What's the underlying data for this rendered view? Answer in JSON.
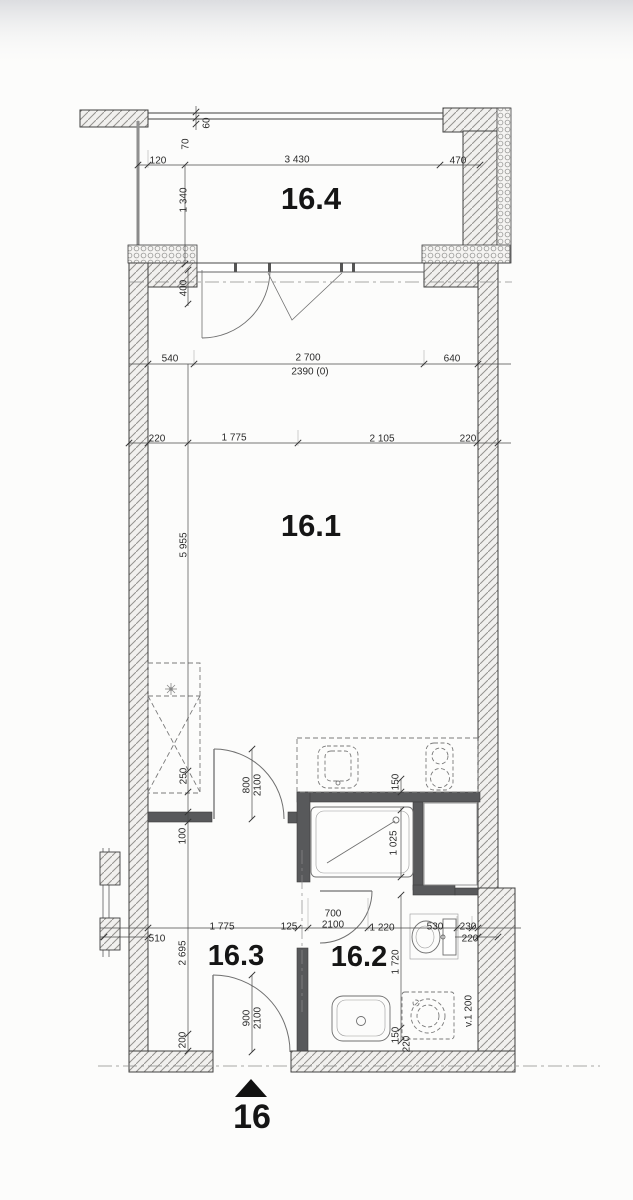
{
  "plan": {
    "title": "apartment-unit-floor-plan",
    "unit": "16",
    "room_labels": [
      {
        "t": "16.4",
        "x": 311,
        "y": 209,
        "size": 31
      },
      {
        "t": "16.1",
        "x": 311,
        "y": 536,
        "size": 31
      },
      {
        "t": "16.3",
        "x": 236,
        "y": 965,
        "size": 29
      },
      {
        "t": "16.2",
        "x": 359,
        "y": 966,
        "size": 29
      },
      {
        "t": "16",
        "x": 252,
        "y": 1128,
        "size": 34
      }
    ],
    "dim_labels": [
      {
        "t": "120",
        "x": 158,
        "y": 160
      },
      {
        "t": "3 430",
        "x": 297,
        "y": 159
      },
      {
        "t": "470",
        "x": 458,
        "y": 160
      },
      {
        "t": "60",
        "x": 206,
        "y": 123,
        "r": 1
      },
      {
        "t": "70",
        "x": 185,
        "y": 144,
        "r": 1
      },
      {
        "t": "1 340",
        "x": 183,
        "y": 200,
        "r": 1
      },
      {
        "t": "400",
        "x": 183,
        "y": 288,
        "r": 1
      },
      {
        "t": "540",
        "x": 170,
        "y": 358
      },
      {
        "t": "2 700",
        "x": 308,
        "y": 357
      },
      {
        "t": "2390 (0)",
        "x": 310,
        "y": 371
      },
      {
        "t": "640",
        "x": 452,
        "y": 358
      },
      {
        "t": "220",
        "x": 157,
        "y": 438
      },
      {
        "t": "1 775",
        "x": 234,
        "y": 437
      },
      {
        "t": "2 105",
        "x": 382,
        "y": 438
      },
      {
        "t": "220",
        "x": 468,
        "y": 438
      },
      {
        "t": "5 955",
        "x": 183,
        "y": 545,
        "r": 1
      },
      {
        "t": "250",
        "x": 183,
        "y": 776,
        "r": 1
      },
      {
        "t": "800",
        "x": 246,
        "y": 785,
        "r": 1
      },
      {
        "t": "2100",
        "x": 257,
        "y": 785,
        "r": 1
      },
      {
        "t": "150",
        "x": 395,
        "y": 782,
        "r": 1
      },
      {
        "t": "100",
        "x": 182,
        "y": 836,
        "r": 1
      },
      {
        "t": "1 025",
        "x": 393,
        "y": 843,
        "r": 1
      },
      {
        "t": "510",
        "x": 157,
        "y": 938
      },
      {
        "t": "1 775",
        "x": 222,
        "y": 926
      },
      {
        "t": "125",
        "x": 289,
        "y": 926
      },
      {
        "t": "700",
        "x": 333,
        "y": 913
      },
      {
        "t": "2100",
        "x": 333,
        "y": 924
      },
      {
        "t": "1 220",
        "x": 382,
        "y": 927
      },
      {
        "t": "530",
        "x": 435,
        "y": 926
      },
      {
        "t": "230",
        "x": 468,
        "y": 926
      },
      {
        "t": "220",
        "x": 470,
        "y": 938
      },
      {
        "t": "2 695",
        "x": 182,
        "y": 953,
        "r": 1
      },
      {
        "t": "1 720",
        "x": 395,
        "y": 962,
        "r": 1
      },
      {
        "t": "900",
        "x": 246,
        "y": 1018,
        "r": 1
      },
      {
        "t": "2100",
        "x": 257,
        "y": 1018,
        "r": 1
      },
      {
        "t": "200",
        "x": 182,
        "y": 1040,
        "r": 1
      },
      {
        "t": "150",
        "x": 395,
        "y": 1035,
        "r": 1
      },
      {
        "t": "220",
        "x": 406,
        "y": 1044,
        "r": 1
      },
      {
        "t": "v.1 200",
        "x": 468,
        "y": 1011,
        "r": 1
      }
    ],
    "colors": {
      "paper": "#fcfcfb",
      "wall_hatch_line": "#94928e",
      "wall_fill": "#f1f0ee",
      "partition": "#58595b",
      "outline": "#3f3f3f",
      "dim_line": "#4a4a4a",
      "fixture": "#6f6f6f",
      "axis": "#8a8a8a",
      "top_shade": "#dcdde0"
    }
  }
}
